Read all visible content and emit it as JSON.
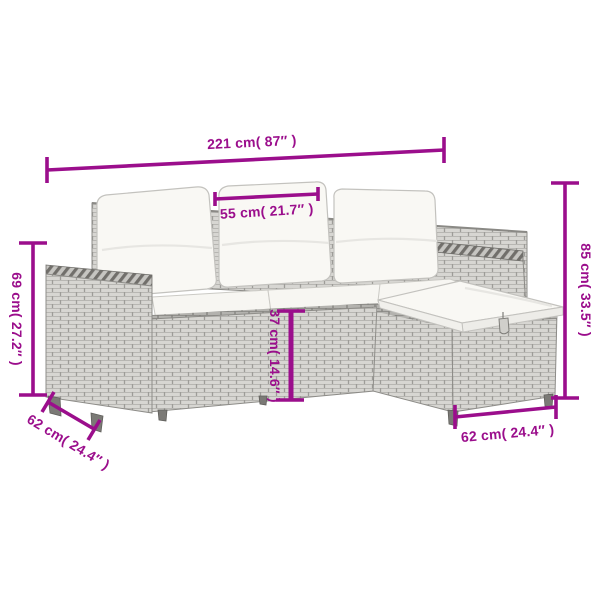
{
  "image": {
    "type": "product-dimension-diagram",
    "subject": "poly-rattan garden lounge set with cushions (3-seat sofa with left armrest, right armrest and footstool)",
    "background_color": "#ffffff",
    "colors": {
      "dimension_accent": "#9b0e8c",
      "wicker_gray": "#d7d6d2",
      "wicker_dark_band": "#b3b2ae",
      "cushion_white": "#f9f8f4"
    }
  },
  "dimensions": {
    "total_width": "221 cm( 87″ )",
    "seat_width": "55 cm( 21.7″ )",
    "backrest_height": "69 cm( 27.2″ )",
    "total_height": "85 cm( 33.5″ )",
    "seat_height": "37 cm( 14.6″ )",
    "sofa_depth": "62 cm( 24.4″ )",
    "footstool_depth": "62 cm( 24.4″ )"
  }
}
